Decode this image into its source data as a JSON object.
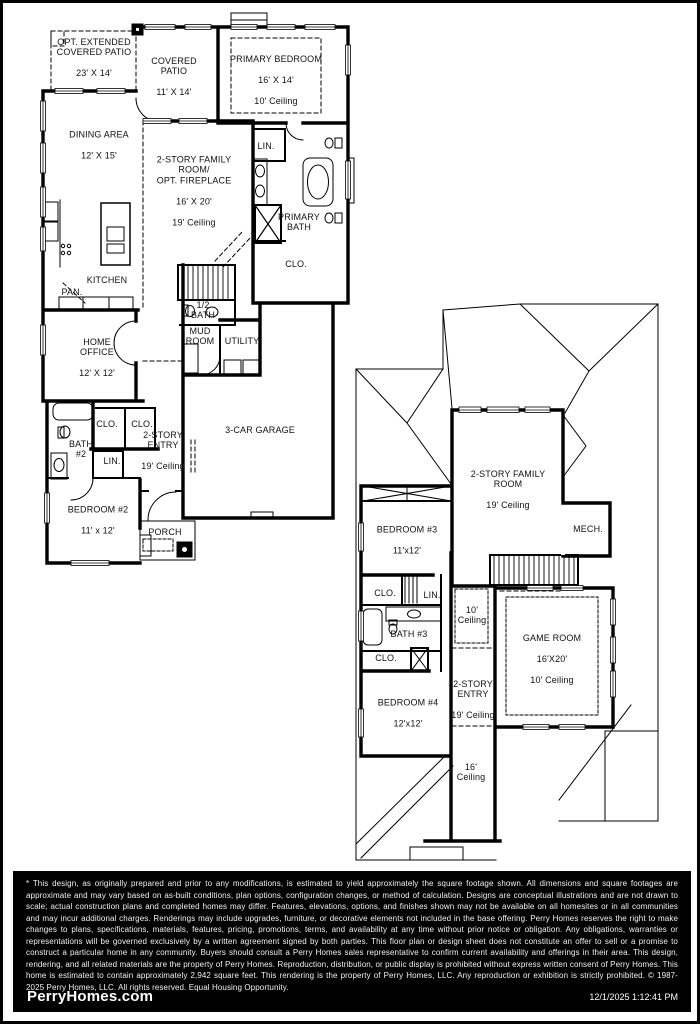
{
  "f1": {
    "opt_patio": {
      "name": "OPT. EXTENDED\nCOVERED PATIO",
      "dims": "23' X 14'"
    },
    "covered_patio": {
      "name": "COVERED\nPATIO",
      "dims": "11' X 14'"
    },
    "primary_bedroom": {
      "name": "PRIMARY BEDROOM",
      "dims": "16' X 14'",
      "ceiling": "10' Ceiling"
    },
    "dining": {
      "name": "DINING AREA",
      "dims": "12' X 15'"
    },
    "family": {
      "name": "2-STORY FAMILY\nROOM/\nOPT. FIREPLACE",
      "dims": "16' X 20'",
      "ceiling": "19' Ceiling"
    },
    "lin": {
      "name": "LIN."
    },
    "primary_bath": {
      "name": "PRIMARY\nBATH"
    },
    "clo": {
      "name": "CLO."
    },
    "kitchen": {
      "name": "KITCHEN"
    },
    "pan": {
      "name": "PAN."
    },
    "half_bath": {
      "name": "1/2\nBATH"
    },
    "mud": {
      "name": "MUD\nROOM"
    },
    "utility": {
      "name": "UTILITY"
    },
    "office": {
      "name": "HOME\nOFFICE",
      "dims": "12' X 12'"
    },
    "clo_a": {
      "name": "CLO."
    },
    "clo_b": {
      "name": "CLO."
    },
    "bath2": {
      "name": "BATH\n#2"
    },
    "lin2": {
      "name": "LIN."
    },
    "entry": {
      "name": "2-STORY\nENTRY",
      "ceiling": "19' Ceiling"
    },
    "garage": {
      "name": "3-CAR GARAGE"
    },
    "bedroom2": {
      "name": "BEDROOM #2",
      "dims": "11' x 12'"
    },
    "porch": {
      "name": "PORCH"
    }
  },
  "f2": {
    "family": {
      "name": "2-STORY FAMILY\nROOM",
      "ceiling": "19' Ceiling"
    },
    "mech": {
      "name": "MECH."
    },
    "bedroom3": {
      "name": "BEDROOM #3",
      "dims": "11'x12'"
    },
    "clo_a": {
      "name": "CLO."
    },
    "lin": {
      "name": "LIN."
    },
    "bath3": {
      "name": "BATH #3"
    },
    "clo_b": {
      "name": "CLO."
    },
    "bedroom4": {
      "name": "BEDROOM #4",
      "dims": "12'x12'"
    },
    "ceiling10": {
      "name": "10'\nCeiling"
    },
    "entry": {
      "name": "2-STORY\nENTRY",
      "ceiling": "19' Ceiling"
    },
    "game": {
      "name": "GAME ROOM",
      "dims": "16'X20'",
      "ceiling": "10' Ceiling"
    },
    "ceiling16": {
      "name": "16'\nCeiling"
    }
  },
  "footer": {
    "disclaimer": "* This design, as originally prepared and prior to any modifications, is estimated to yield approximately the square footage shown.  All dimensions and square footages are approximate and may vary based on as-built conditions, plan options, configuration changes, or method of calculation.  Designs are conceptual illustrations and are not drawn to scale; actual construction plans and completed homes may differ.  Features, elevations, options, and finishes shown may not be available on all homesites or in all communities and may incur additional charges.  Renderings may include upgrades, furniture, or decorative elements not included in the base offering.  Perry Homes reserves the right to make changes to plans, specifications, materials, features, pricing, promotions, terms, and availability at any time without prior notice or obligation.  Any obligations, warranties or representations will be governed exclusively by a written agreement signed by both parties.  This floor plan or design sheet does not constitute an offer to sell or a promise to construct a particular home in any community.  Buyers should consult a Perry Homes sales representative to confirm current availability and offerings in their area.  This design, rendering, and all related materials are the property of Perry Homes.  Reproduction, distribution, or public display is prohibited without express written consent of Perry Homes.  This home is estimated to contain approximately 2,942 square feet.  This rendering is the property of Perry Homes, LLC.  Any reproduction or exhibition is strictly prohibited. © 1987-2025 Perry Homes, LLC.  All rights reserved.  Equal Housing Opportunity.",
    "brand": "PerryHomes.com",
    "timestamp": "12/1/2025 1:12:41 PM"
  },
  "colors": {
    "ink": "#000000",
    "paper": "#ffffff",
    "footer_bg": "#000000"
  }
}
